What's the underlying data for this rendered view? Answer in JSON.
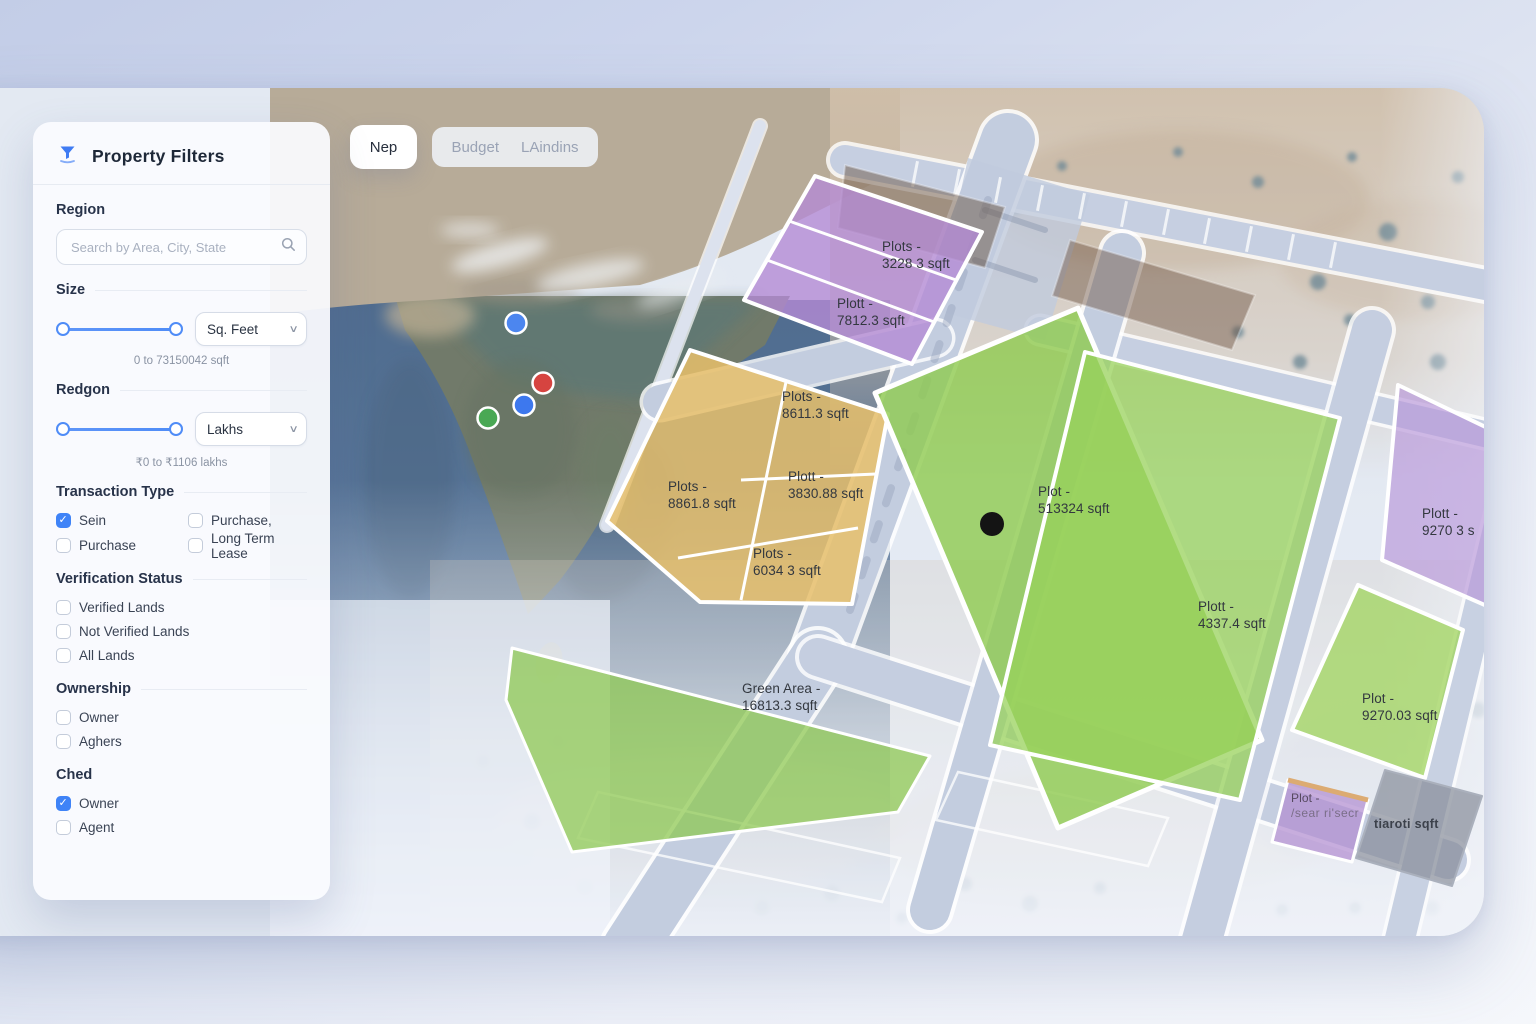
{
  "header_tabs": {
    "active": "Nep",
    "inactive": [
      "Budget",
      "LAindins"
    ]
  },
  "sidebar": {
    "title": "Property Filters",
    "region": {
      "heading": "Region",
      "search_placeholder": "Search by Area, City, State"
    },
    "size": {
      "heading": "Size",
      "unit": "Sq. Feet",
      "range_caption": "0 to 73150042 sqft"
    },
    "budget": {
      "heading": "Redgon",
      "unit": "Lakhs",
      "range_caption": "₹0 to ₹1106 lakhs"
    },
    "transaction_type": {
      "heading": "Transaction Type",
      "options": [
        {
          "label": "Sein",
          "checked": true
        },
        {
          "label": "Purchase,",
          "checked": false
        },
        {
          "label": "Purchase",
          "checked": false
        },
        {
          "label": "Long Term Lease",
          "checked": false
        }
      ]
    },
    "verification": {
      "heading": "Verification Status",
      "options": [
        {
          "label": "Verified Lands",
          "checked": false
        },
        {
          "label": "Not Verified Lands",
          "checked": false
        },
        {
          "label": "All Lands",
          "checked": false
        }
      ]
    },
    "ownership": {
      "heading": "Ownership",
      "options": [
        {
          "label": "Owner",
          "checked": false
        },
        {
          "label": "Aghers",
          "checked": false
        }
      ]
    },
    "ched": {
      "heading": "Ched",
      "options": [
        {
          "label": "Owner",
          "checked": true
        },
        {
          "label": "Agent",
          "checked": false
        }
      ]
    }
  },
  "map": {
    "labels": [
      {
        "line1": "Plots -",
        "line2": "3228 3 sqft"
      },
      {
        "line1": "Plott -",
        "line2": "7812.3 sqft"
      },
      {
        "line1": "Plots -",
        "line2": "8611.3 sqft"
      },
      {
        "line1": "Plots -",
        "line2": "8861.8 sqft"
      },
      {
        "line1": "Plott -",
        "line2": "3830.88 sqft"
      },
      {
        "line1": "Plots -",
        "line2": "6034 3 sqft"
      },
      {
        "line1": "Plot -",
        "line2": "513324 sqft"
      },
      {
        "line1": "Plott -",
        "line2": "4337.4 sqft"
      },
      {
        "line1": "Plott -",
        "line2": "9270 3 s"
      },
      {
        "line1": "Plot -",
        "line2": "9270.03 sqft"
      },
      {
        "line1": "Plot -",
        "line2": "/sear ri'secr"
      },
      {
        "line1": "tiaroti sqft",
        "line2": ""
      },
      {
        "line1": "Green Area -",
        "line2": "16813.3 sqft"
      }
    ],
    "plot_colors": {
      "purple": "#b48bd4",
      "yellow": "#e7c06b",
      "green": "#8ecb4f"
    },
    "marker_colors": {
      "blue": "#4c86ef",
      "red": "#d64440",
      "green": "#49a854",
      "selected_dot": "#141414"
    }
  }
}
